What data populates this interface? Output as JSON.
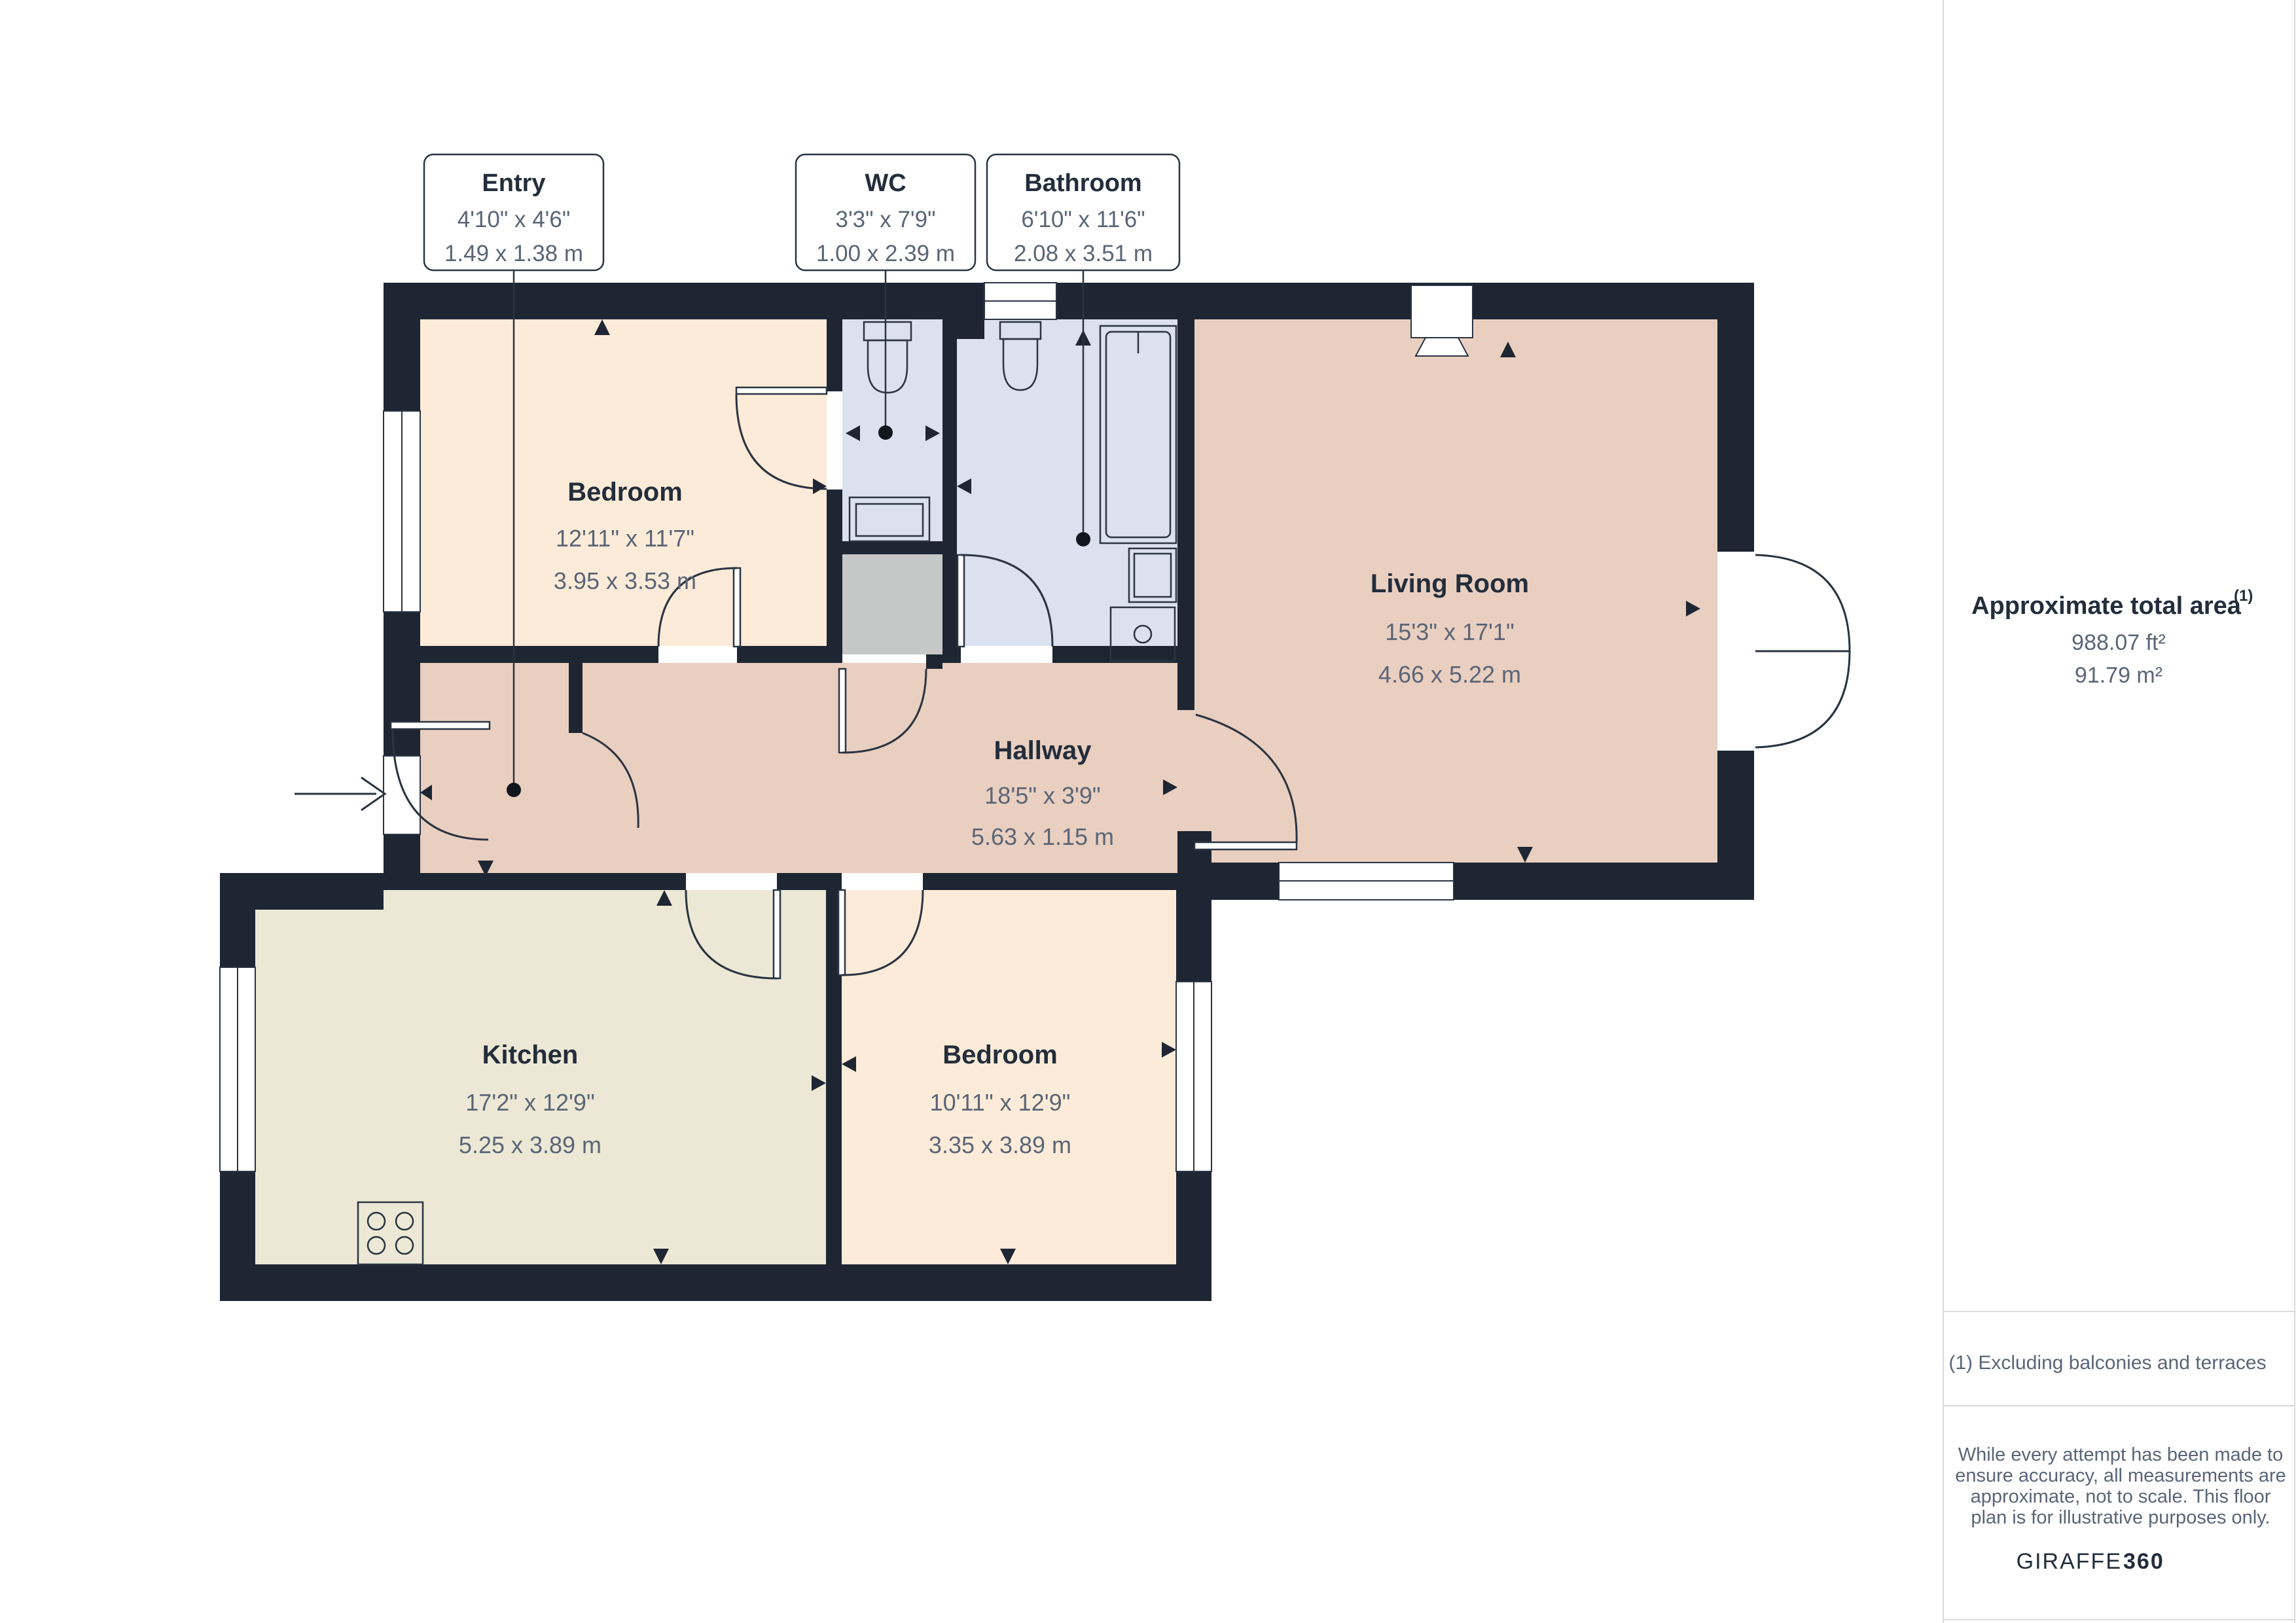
{
  "floorplan": {
    "callouts": [
      {
        "name": "Entry",
        "dims_ft": "4'10\" x 4'6\"",
        "dims_m": "1.49 x 1.38 m"
      },
      {
        "name": "WC",
        "dims_ft": "3'3\" x 7'9\"",
        "dims_m": "1.00 x 2.39 m"
      },
      {
        "name": "Bathroom",
        "dims_ft": "6'10\" x 11'6\"",
        "dims_m": "2.08 x 3.51 m"
      }
    ],
    "rooms": [
      {
        "name": "Bedroom",
        "dims_ft": "12'11\" x 11'7\"",
        "dims_m": "3.95 x 3.53 m"
      },
      {
        "name": "Living Room",
        "dims_ft": "15'3\" x 17'1\"",
        "dims_m": "4.66 x 5.22 m"
      },
      {
        "name": "Hallway",
        "dims_ft": "18'5\" x 3'9\"",
        "dims_m": "5.63 x 1.15 m"
      },
      {
        "name": "Kitchen",
        "dims_ft": "17'2\" x 12'9\"",
        "dims_m": "5.25 x 3.89 m"
      },
      {
        "name": "Bedroom",
        "dims_ft": "10'11\" x 12'9\"",
        "dims_m": "3.35 x 3.89 m"
      }
    ]
  },
  "sidebar": {
    "area_title": "Approximate total area",
    "area_superscript": "(1)",
    "area_ft": "988.07 ft²",
    "area_m": "91.79 m²",
    "footnote": "(1) Excluding balconies and terraces",
    "disclaimer_lines": [
      "While every attempt has been made to",
      "ensure accuracy, all measurements are",
      "approximate, not to scale. This floor",
      "plan is for illustrative purposes only."
    ],
    "brand": {
      "name": "GIRAFFE",
      "suffix": "360"
    }
  },
  "colors": {
    "wall": "#1E2633",
    "bedroom_fill": "#FCEBD8",
    "living_hall_fill": "#E9CFC0",
    "wet_room_fill": "#DBE1EE",
    "kitchen_fill": "#EDE8D5",
    "closet_fill": "#C6C7C7",
    "line": "#2A3442",
    "text_dark": "#232D3B",
    "text_muted": "#5A6577",
    "divider": "#DBDBDB"
  }
}
